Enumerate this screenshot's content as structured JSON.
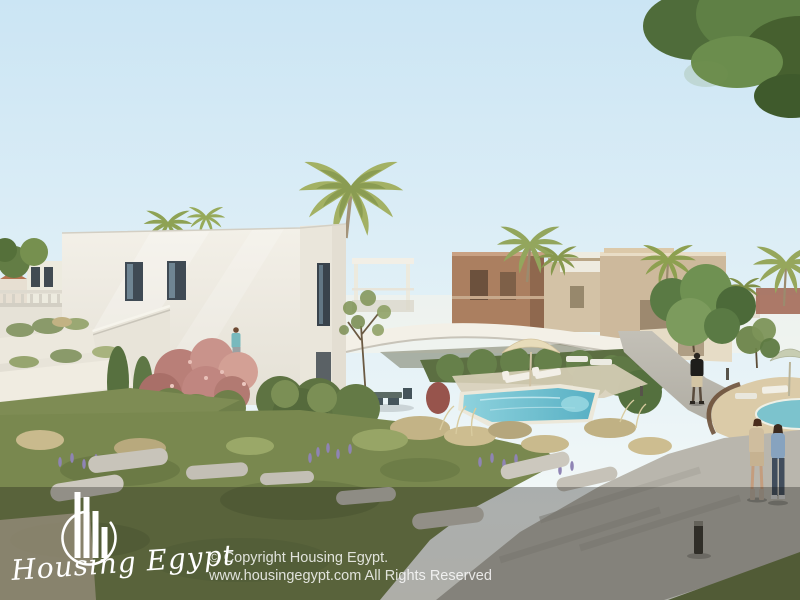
{
  "scene": {
    "type": "architectural-render-photo",
    "subject": "Residential compound: white modern villas, palm trees, swimming pool, landscaped gardens and walking paths with people"
  },
  "watermark": {
    "brand_name": "Housing Egypt",
    "logo_icon": "buildings-bar-chart-in-circle-icon",
    "copyright_line1": "© Copyright Housing Egypt.",
    "copyright_line2": "www.housingegypt.com All Rights Reserved"
  },
  "colors": {
    "sky_top": "#cbe5f4",
    "sky_horizon": "#f4f7f2",
    "villa_white": "#efece3",
    "building_brown": "#ab7f60",
    "building_tan": "#cdb99c",
    "pool_water": "#6fc2d2",
    "foliage_dark": "#4e6c38",
    "foliage_light": "#93a35e",
    "palm_green": "#9cab5e",
    "grass_green": "#79884f",
    "dried_grass": "#c9b98b",
    "flower_pink": "#c98c85",
    "lavender_purple": "#8f84b4",
    "path_gray": "#b7b4ac",
    "sand_deck": "#dbcba8",
    "overlay_tint": "rgba(21,23,20,0.32)",
    "watermark_white": "#ffffff"
  }
}
